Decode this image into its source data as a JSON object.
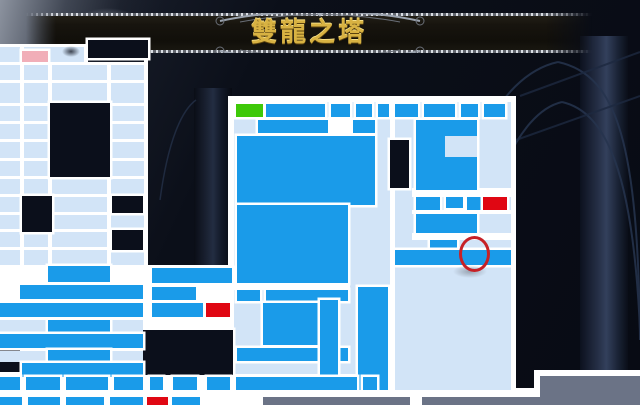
{
  "title": {
    "text": "雙龍之塔"
  },
  "palette": {
    "pale": "#D2E4F7",
    "bright": "#1A9BE9",
    "white": "#FFFFFF",
    "red": "#E00713",
    "green": "#3EC908",
    "pink": "#F1AEB8",
    "grey": "#6B7386",
    "dark": "#0B0F1B"
  },
  "banner": {
    "gold": "#D8B242",
    "silver": "#9BA3AF"
  },
  "map": {
    "cells": [
      {
        "n": "panel-border-central",
        "x": 228,
        "y": 96,
        "w": 168,
        "h": 284,
        "c": "white"
      },
      {
        "n": "panel-border-right",
        "x": 390,
        "y": 96,
        "w": 126,
        "h": 299,
        "c": "white"
      },
      {
        "n": "underlay-bottom-left",
        "x": 0,
        "y": 265,
        "w": 148,
        "h": 140,
        "c": "white"
      },
      {
        "n": "underlay-mid-cluster",
        "x": 144,
        "y": 265,
        "w": 92,
        "h": 69,
        "c": "white"
      },
      {
        "n": "underlay-mid-bottom",
        "x": 144,
        "y": 372,
        "w": 246,
        "h": 33,
        "c": "white"
      },
      {
        "n": "underlay-bottom-right",
        "x": 388,
        "y": 388,
        "w": 152,
        "h": 17,
        "c": "white"
      },
      {
        "n": "inset-border",
        "x": 534,
        "y": 370,
        "w": 106,
        "h": 35,
        "c": "white"
      },
      {
        "n": "wall-top-left",
        "x": 0,
        "y": 44,
        "w": 88,
        "h": 4,
        "c": "white"
      },
      {
        "n": "room-block-a",
        "x": 0,
        "y": 47,
        "w": 84,
        "h": 15,
        "c": "pale"
      },
      {
        "n": "room-small-b",
        "x": 50,
        "y": 47,
        "w": 28,
        "h": 15,
        "c": "pale"
      },
      {
        "n": "band-upper-left",
        "x": 0,
        "y": 65,
        "w": 148,
        "h": 131,
        "c": "pale"
      },
      {
        "n": "band-mid-left",
        "x": 0,
        "y": 196,
        "w": 148,
        "h": 69,
        "c": "pale"
      },
      {
        "n": "interior-central",
        "x": 234,
        "y": 102,
        "w": 156,
        "h": 272,
        "c": "pale"
      },
      {
        "n": "interior-right",
        "x": 395,
        "y": 102,
        "w": 116,
        "h": 288,
        "c": "pale"
      },
      {
        "n": "wall-h1",
        "x": 0,
        "y": 62,
        "w": 148,
        "h": 3,
        "c": "white"
      },
      {
        "n": "wall-h2",
        "x": 0,
        "y": 80,
        "w": 148,
        "h": 3,
        "c": "white"
      },
      {
        "n": "wall-h3",
        "x": 0,
        "y": 103,
        "w": 148,
        "h": 3,
        "c": "white"
      },
      {
        "n": "wall-h4",
        "x": 0,
        "y": 121,
        "w": 148,
        "h": 3,
        "c": "white"
      },
      {
        "n": "wall-h5",
        "x": 0,
        "y": 139,
        "w": 148,
        "h": 3,
        "c": "white"
      },
      {
        "n": "wall-h6",
        "x": 0,
        "y": 158,
        "w": 148,
        "h": 3,
        "c": "white"
      },
      {
        "n": "wall-h7",
        "x": 0,
        "y": 176,
        "w": 148,
        "h": 3,
        "c": "white"
      },
      {
        "n": "wall-h8",
        "x": 0,
        "y": 194,
        "w": 148,
        "h": 3,
        "c": "white"
      },
      {
        "n": "wall-h9",
        "x": 0,
        "y": 212,
        "w": 148,
        "h": 3,
        "c": "white"
      },
      {
        "n": "wall-h10",
        "x": 0,
        "y": 229,
        "w": 148,
        "h": 3,
        "c": "white"
      },
      {
        "n": "wall-h11",
        "x": 0,
        "y": 247,
        "w": 148,
        "h": 3,
        "c": "white"
      },
      {
        "n": "wall-v1",
        "x": 20,
        "y": 47,
        "w": 4,
        "h": 218,
        "c": "white"
      },
      {
        "n": "wall-v2",
        "x": 48,
        "y": 62,
        "w": 4,
        "h": 203,
        "c": "white"
      },
      {
        "n": "wall-v3",
        "x": 84,
        "y": 44,
        "w": 4,
        "h": 21,
        "c": "white"
      },
      {
        "n": "wall-v4",
        "x": 107,
        "y": 62,
        "w": 4,
        "h": 203,
        "c": "white"
      },
      {
        "n": "wall-v5",
        "x": 144,
        "y": 44,
        "w": 4,
        "h": 361,
        "c": "white"
      },
      {
        "n": "wall-block-c1",
        "x": 328,
        "y": 117,
        "w": 24,
        "h": 17,
        "c": "white"
      },
      {
        "n": "wall-band-c2",
        "x": 234,
        "y": 283,
        "w": 116,
        "h": 7,
        "c": "white"
      },
      {
        "n": "wall-band-r1",
        "x": 412,
        "y": 188,
        "w": 99,
        "h": 9,
        "c": "white"
      },
      {
        "n": "wall-band-r2",
        "x": 412,
        "y": 210,
        "w": 99,
        "h": 4,
        "c": "white"
      },
      {
        "n": "wall-band-r3",
        "x": 412,
        "y": 233,
        "w": 99,
        "h": 7,
        "c": "white"
      },
      {
        "n": "notch-n1",
        "x": 88,
        "y": 40,
        "w": 60,
        "h": 18,
        "c": "dark"
      },
      {
        "n": "notch-n2",
        "x": 50,
        "y": 103,
        "w": 60,
        "h": 74,
        "c": "dark"
      },
      {
        "n": "notch-n3",
        "x": 22,
        "y": 196,
        "w": 30,
        "h": 36,
        "c": "dark"
      },
      {
        "n": "notch-n4",
        "x": 112,
        "y": 196,
        "w": 31,
        "h": 17,
        "c": "dark"
      },
      {
        "n": "notch-n5",
        "x": 112,
        "y": 230,
        "w": 31,
        "h": 20,
        "c": "dark"
      },
      {
        "n": "notch-n6",
        "x": 0,
        "y": 340,
        "w": 20,
        "h": 32,
        "c": "dark"
      },
      {
        "n": "notch-n7",
        "x": 143,
        "y": 330,
        "w": 90,
        "h": 45,
        "c": "dark"
      },
      {
        "n": "notch-n8",
        "x": 390,
        "y": 140,
        "w": 19,
        "h": 48,
        "c": "dark"
      },
      {
        "n": "strip-row-a",
        "x": 0,
        "y": 320,
        "w": 143,
        "h": 12,
        "c": "pale"
      },
      {
        "n": "strip-row-b",
        "x": 0,
        "y": 351,
        "w": 143,
        "h": 11,
        "c": "pale"
      },
      {
        "n": "room-top-a",
        "x": 266,
        "y": 104,
        "w": 59,
        "h": 13,
        "c": "bright"
      },
      {
        "n": "room-top-b",
        "x": 331,
        "y": 104,
        "w": 19,
        "h": 13,
        "c": "bright"
      },
      {
        "n": "room-top-c",
        "x": 356,
        "y": 104,
        "w": 16,
        "h": 13,
        "c": "bright"
      },
      {
        "n": "room-top-d",
        "x": 378,
        "y": 104,
        "w": 11,
        "h": 13,
        "c": "bright"
      },
      {
        "n": "room-rtop-a",
        "x": 395,
        "y": 104,
        "w": 23,
        "h": 13,
        "c": "bright"
      },
      {
        "n": "room-rtop-b",
        "x": 424,
        "y": 104,
        "w": 31,
        "h": 13,
        "c": "bright"
      },
      {
        "n": "room-rtop-c",
        "x": 461,
        "y": 104,
        "w": 17,
        "h": 13,
        "c": "bright"
      },
      {
        "n": "room-rtop-d",
        "x": 484,
        "y": 104,
        "w": 21,
        "h": 13,
        "c": "bright"
      },
      {
        "n": "room-row2-a",
        "x": 258,
        "y": 120,
        "w": 70,
        "h": 13,
        "c": "bright"
      },
      {
        "n": "room-row2-b",
        "x": 353,
        "y": 120,
        "w": 22,
        "h": 13,
        "c": "bright"
      },
      {
        "n": "hall-upper",
        "x": 237,
        "y": 136,
        "w": 138,
        "h": 69,
        "c": "bright"
      },
      {
        "n": "hall-lower",
        "x": 237,
        "y": 205,
        "w": 111,
        "h": 78,
        "c": "bright"
      },
      {
        "n": "room-row3-a",
        "x": 237,
        "y": 290,
        "w": 23,
        "h": 11,
        "c": "bright"
      },
      {
        "n": "room-row3-b",
        "x": 266,
        "y": 290,
        "w": 82,
        "h": 11,
        "c": "bright"
      },
      {
        "n": "room-block-c",
        "x": 263,
        "y": 303,
        "w": 70,
        "h": 42,
        "c": "bright"
      },
      {
        "n": "room-band-c",
        "x": 237,
        "y": 348,
        "w": 111,
        "h": 13,
        "c": "bright"
      },
      {
        "n": "column-right-c",
        "x": 358,
        "y": 287,
        "w": 30,
        "h": 103,
        "c": "bright"
      },
      {
        "n": "column-left-c",
        "x": 320,
        "y": 300,
        "w": 18,
        "h": 90,
        "c": "bright"
      },
      {
        "n": "tower-right",
        "x": 416,
        "y": 120,
        "w": 61,
        "h": 70,
        "c": "bright"
      },
      {
        "n": "tower-right-inset",
        "x": 445,
        "y": 136,
        "w": 32,
        "h": 21,
        "c": "pale"
      },
      {
        "n": "room-r1",
        "x": 416,
        "y": 197,
        "w": 24,
        "h": 13,
        "c": "bright"
      },
      {
        "n": "room-r2",
        "x": 467,
        "y": 197,
        "w": 16,
        "h": 13,
        "c": "bright"
      },
      {
        "n": "room-r3",
        "x": 446,
        "y": 197,
        "w": 17,
        "h": 11,
        "c": "bright"
      },
      {
        "n": "room-r4",
        "x": 416,
        "y": 214,
        "w": 61,
        "h": 19,
        "c": "bright"
      },
      {
        "n": "room-r5",
        "x": 430,
        "y": 240,
        "w": 27,
        "h": 10,
        "c": "bright"
      },
      {
        "n": "room-r6",
        "x": 395,
        "y": 250,
        "w": 116,
        "h": 15,
        "c": "bright"
      },
      {
        "n": "bl-room-1",
        "x": 48,
        "y": 266,
        "w": 62,
        "h": 16,
        "c": "bright"
      },
      {
        "n": "bl-room-2",
        "x": 20,
        "y": 285,
        "w": 123,
        "h": 14,
        "c": "bright"
      },
      {
        "n": "bl-room-3",
        "x": 152,
        "y": 287,
        "w": 44,
        "h": 13,
        "c": "bright"
      },
      {
        "n": "bl-room-4",
        "x": 0,
        "y": 303,
        "w": 143,
        "h": 14,
        "c": "bright"
      },
      {
        "n": "bl-room-5",
        "x": 152,
        "y": 303,
        "w": 51,
        "h": 14,
        "c": "bright"
      },
      {
        "n": "bl-room-6",
        "x": 48,
        "y": 320,
        "w": 62,
        "h": 12,
        "c": "bright"
      },
      {
        "n": "bl-room-7",
        "x": 0,
        "y": 334,
        "w": 143,
        "h": 14,
        "c": "bright"
      },
      {
        "n": "bl-room-8",
        "x": 48,
        "y": 350,
        "w": 62,
        "h": 12,
        "c": "bright"
      },
      {
        "n": "bl-room-9",
        "x": 22,
        "y": 363,
        "w": 121,
        "h": 14,
        "c": "bright"
      },
      {
        "n": "bl-room-10",
        "x": 152,
        "y": 268,
        "w": 80,
        "h": 15,
        "c": "bright"
      },
      {
        "n": "bb-room-1",
        "x": 0,
        "y": 377,
        "w": 20,
        "h": 13,
        "c": "bright"
      },
      {
        "n": "bb-room-2",
        "x": 26,
        "y": 377,
        "w": 34,
        "h": 13,
        "c": "bright"
      },
      {
        "n": "bb-room-3",
        "x": 66,
        "y": 377,
        "w": 42,
        "h": 13,
        "c": "bright"
      },
      {
        "n": "bb-room-4",
        "x": 114,
        "y": 377,
        "w": 29,
        "h": 13,
        "c": "bright"
      },
      {
        "n": "bb-room-5",
        "x": 150,
        "y": 377,
        "w": 13,
        "h": 13,
        "c": "bright"
      },
      {
        "n": "bb-room-6",
        "x": 173,
        "y": 377,
        "w": 24,
        "h": 13,
        "c": "bright"
      },
      {
        "n": "bb-room-7",
        "x": 207,
        "y": 377,
        "w": 23,
        "h": 13,
        "c": "bright"
      },
      {
        "n": "bb-room-8",
        "x": 236,
        "y": 377,
        "w": 121,
        "h": 13,
        "c": "bright"
      },
      {
        "n": "bb-room-9",
        "x": 363,
        "y": 377,
        "w": 14,
        "h": 13,
        "c": "bright"
      },
      {
        "n": "bc-room-1",
        "x": 0,
        "y": 397,
        "w": 22,
        "h": 8,
        "c": "bright"
      },
      {
        "n": "bc-room-2",
        "x": 28,
        "y": 397,
        "w": 32,
        "h": 8,
        "c": "bright"
      },
      {
        "n": "bc-room-3",
        "x": 66,
        "y": 397,
        "w": 38,
        "h": 8,
        "c": "bright"
      },
      {
        "n": "bc-room-4",
        "x": 110,
        "y": 397,
        "w": 33,
        "h": 8,
        "c": "bright"
      },
      {
        "n": "bc-room-5",
        "x": 172,
        "y": 397,
        "w": 28,
        "h": 8,
        "c": "bright"
      },
      {
        "n": "entrance-room-green",
        "x": 236,
        "y": 104,
        "w": 27,
        "h": 13,
        "c": "green"
      },
      {
        "n": "room-pink",
        "x": 22,
        "y": 51,
        "w": 26,
        "h": 11,
        "c": "pink"
      },
      {
        "n": "save-room-red-left",
        "x": 206,
        "y": 303,
        "w": 24,
        "h": 14,
        "c": "red"
      },
      {
        "n": "save-room-red-right",
        "x": 483,
        "y": 197,
        "w": 24,
        "h": 13,
        "c": "red"
      },
      {
        "n": "save-room-red-bottom",
        "x": 147,
        "y": 397,
        "w": 21,
        "h": 8,
        "c": "red"
      },
      {
        "n": "legend-bar",
        "x": 263,
        "y": 397,
        "w": 277,
        "h": 8,
        "c": "grey"
      },
      {
        "n": "legend-inset",
        "x": 540,
        "y": 376,
        "w": 100,
        "h": 29,
        "c": "grey"
      },
      {
        "n": "legend-bar-notch",
        "x": 410,
        "y": 395,
        "w": 12,
        "h": 10,
        "c": "white"
      }
    ]
  },
  "annotations": {
    "target_circle": {
      "x": 459,
      "y": 236,
      "w": 25,
      "h": 30,
      "stroke": "#C62026",
      "stroke_width": 3.5
    },
    "circle_shadow": {
      "x": 453,
      "y": 265,
      "w": 34,
      "h": 13
    },
    "cursor_smudge": {
      "x": 62,
      "y": 46,
      "w": 18,
      "h": 11
    }
  }
}
